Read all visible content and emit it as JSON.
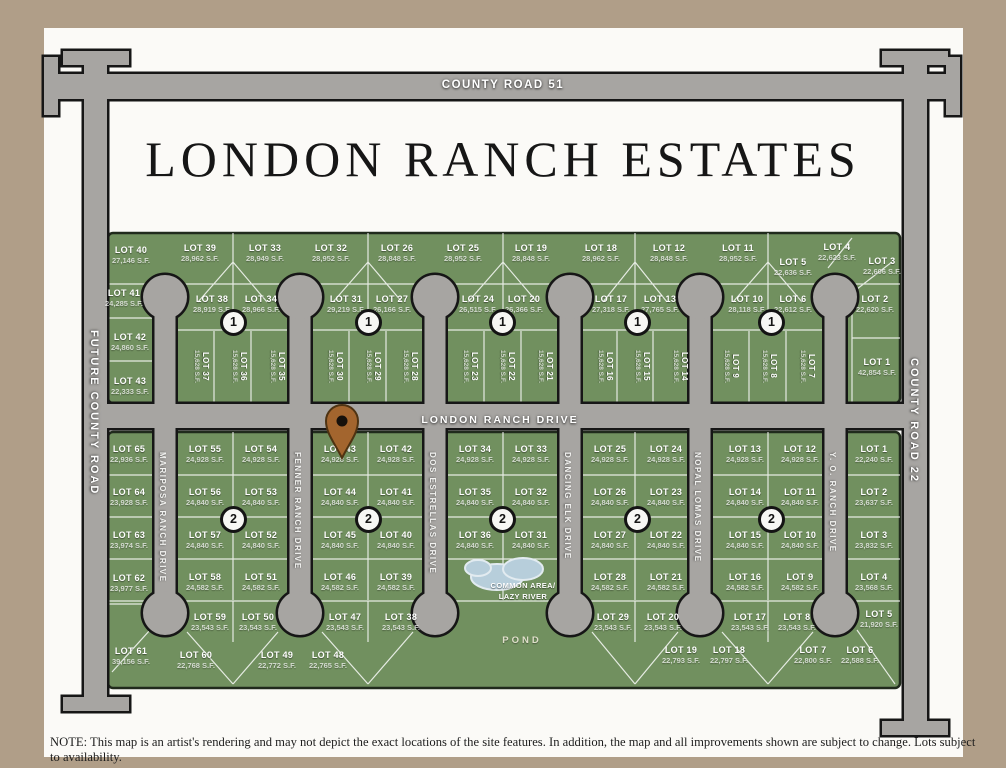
{
  "page": {
    "title": "LONDON RANCH ESTATES",
    "note": "NOTE: This map is an artist's rendering and may not depict the exact locations of the site features. In addition, the map and all improvements shown are subject to change. Lots subject to availability."
  },
  "roads": {
    "county_road_51": "COUNTY ROAD 51",
    "future_county_road": "FUTURE COUNTY ROAD",
    "county_road_22": "COUNTY ROAD 22",
    "london_ranch_drive": "LONDON RANCH DRIVE",
    "drives": [
      {
        "name": "MARIPOSA RANCH DRIVE",
        "x": 165
      },
      {
        "name": "FENNER RANCH DRIVE",
        "x": 300
      },
      {
        "name": "DOS ESTRELLAS DRIVE",
        "x": 435
      },
      {
        "name": "DANCING ELK DRIVE",
        "x": 570
      },
      {
        "name": "NOPAL LOMAS DRIVE",
        "x": 700
      },
      {
        "name": "Y. O. RANCH DRIVE",
        "x": 835
      }
    ]
  },
  "section_markers": [
    {
      "label": "1",
      "points": [
        [
          233,
          322
        ],
        [
          368,
          322
        ],
        [
          502,
          322
        ],
        [
          637,
          322
        ],
        [
          771,
          322
        ]
      ]
    },
    {
      "label": "2",
      "points": [
        [
          233,
          519
        ],
        [
          368,
          519
        ],
        [
          502,
          519
        ],
        [
          637,
          519
        ],
        [
          771,
          519
        ]
      ]
    }
  ],
  "common_area": {
    "line1": "COMMON AREA/",
    "line2": "LAZY RIVER",
    "pond_label": "POND"
  },
  "lots_upper": [
    {
      "n": "LOT 40",
      "sf": "27,146 S.F.",
      "x": 131,
      "y": 254
    },
    {
      "n": "LOT 39",
      "sf": "28,962 S.F.",
      "x": 200,
      "y": 252
    },
    {
      "n": "LOT 33",
      "sf": "28,949 S.F.",
      "x": 265,
      "y": 252
    },
    {
      "n": "LOT 32",
      "sf": "28,952 S.F.",
      "x": 331,
      "y": 252
    },
    {
      "n": "LOT 26",
      "sf": "28,848 S.F.",
      "x": 397,
      "y": 252
    },
    {
      "n": "LOT 25",
      "sf": "28,952 S.F.",
      "x": 463,
      "y": 252
    },
    {
      "n": "LOT 19",
      "sf": "28,848 S.F.",
      "x": 531,
      "y": 252
    },
    {
      "n": "LOT 18",
      "sf": "28,962 S.F.",
      "x": 601,
      "y": 252
    },
    {
      "n": "LOT 12",
      "sf": "28,848 S.F.",
      "x": 669,
      "y": 252
    },
    {
      "n": "LOT 11",
      "sf": "28,952 S.F.",
      "x": 738,
      "y": 252
    },
    {
      "n": "LOT 5",
      "sf": "22,636 S.F.",
      "x": 793,
      "y": 266
    },
    {
      "n": "LOT 4",
      "sf": "22,623 S.F.",
      "x": 837,
      "y": 251
    },
    {
      "n": "LOT 3",
      "sf": "22,606 S.F.",
      "x": 882,
      "y": 265
    },
    {
      "n": "LOT 41",
      "sf": "24,285 S.F.",
      "x": 124,
      "y": 297
    },
    {
      "n": "LOT 38",
      "sf": "28,919 S.F.",
      "x": 212,
      "y": 303
    },
    {
      "n": "LOT 34",
      "sf": "28,966 S.F.",
      "x": 261,
      "y": 303
    },
    {
      "n": "LOT 31",
      "sf": "29,219 S.F.",
      "x": 346,
      "y": 303
    },
    {
      "n": "LOT 27",
      "sf": "26,166 S.F.",
      "x": 392,
      "y": 303
    },
    {
      "n": "LOT 24",
      "sf": "26,515 S.F.",
      "x": 478,
      "y": 303
    },
    {
      "n": "LOT 20",
      "sf": "26,366 S.F.",
      "x": 524,
      "y": 303
    },
    {
      "n": "LOT 17",
      "sf": "27,318 S.F.",
      "x": 611,
      "y": 303
    },
    {
      "n": "LOT 13",
      "sf": "27,765 S.F.",
      "x": 660,
      "y": 303
    },
    {
      "n": "LOT 10",
      "sf": "28,118 S.F.",
      "x": 747,
      "y": 303
    },
    {
      "n": "LOT 6",
      "sf": "22,612 S.F.",
      "x": 793,
      "y": 303
    },
    {
      "n": "LOT 2",
      "sf": "22,620 S.F.",
      "x": 875,
      "y": 303
    },
    {
      "n": "LOT 42",
      "sf": "24,860 S.F.",
      "x": 130,
      "y": 341
    },
    {
      "n": "LOT 43",
      "sf": "22,333 S.F.",
      "x": 130,
      "y": 385
    },
    {
      "n": "LOT 37",
      "sf": "15,628 S.F.",
      "x": 198,
      "y": 366,
      "v": 1
    },
    {
      "n": "LOT 36",
      "sf": "15,628 S.F.",
      "x": 236,
      "y": 366,
      "v": 1
    },
    {
      "n": "LOT 35",
      "sf": "15,628 S.F.",
      "x": 274,
      "y": 366,
      "v": 1
    },
    {
      "n": "LOT 30",
      "sf": "15,628 S.F.",
      "x": 332,
      "y": 366,
      "v": 1
    },
    {
      "n": "LOT 29",
      "sf": "15,628 S.F.",
      "x": 370,
      "y": 366,
      "v": 1
    },
    {
      "n": "LOT 28",
      "sf": "15,628 S.F.",
      "x": 407,
      "y": 366,
      "v": 1
    },
    {
      "n": "LOT 23",
      "sf": "15,628 S.F.",
      "x": 467,
      "y": 366,
      "v": 1
    },
    {
      "n": "LOT 22",
      "sf": "15,628 S.F.",
      "x": 504,
      "y": 366,
      "v": 1
    },
    {
      "n": "LOT 21",
      "sf": "15,628 S.F.",
      "x": 542,
      "y": 366,
      "v": 1
    },
    {
      "n": "LOT 16",
      "sf": "15,628 S.F.",
      "x": 602,
      "y": 366,
      "v": 1
    },
    {
      "n": "LOT 15",
      "sf": "15,628 S.F.",
      "x": 639,
      "y": 366,
      "v": 1
    },
    {
      "n": "LOT 14",
      "sf": "15,628 S.F.",
      "x": 677,
      "y": 366,
      "v": 1
    },
    {
      "n": "LOT 9",
      "sf": "15,628 S.F.",
      "x": 728,
      "y": 366,
      "v": 1
    },
    {
      "n": "LOT 8",
      "sf": "15,628 S.F.",
      "x": 766,
      "y": 366,
      "v": 1
    },
    {
      "n": "LOT 7",
      "sf": "15,628 S.F.",
      "x": 804,
      "y": 366,
      "v": 1
    },
    {
      "n": "LOT 1",
      "sf": "42,854 S.F.",
      "x": 877,
      "y": 366
    }
  ],
  "lots_lower": [
    {
      "n": "LOT 65",
      "sf": "22,936 S.F.",
      "x": 129,
      "y": 453
    },
    {
      "n": "LOT 64",
      "sf": "23,928 S.F.",
      "x": 129,
      "y": 496
    },
    {
      "n": "LOT 63",
      "sf": "23,974 S.F.",
      "x": 129,
      "y": 539
    },
    {
      "n": "LOT 62",
      "sf": "23,977 S.F.",
      "x": 129,
      "y": 582
    },
    {
      "n": "LOT 61",
      "sf": "39,156 S.F.",
      "x": 131,
      "y": 655
    },
    {
      "n": "LOT 55",
      "sf": "24,928 S.F.",
      "x": 205,
      "y": 453
    },
    {
      "n": "LOT 54",
      "sf": "24,928 S.F.",
      "x": 261,
      "y": 453
    },
    {
      "n": "LOT 56",
      "sf": "24,840 S.F.",
      "x": 205,
      "y": 496
    },
    {
      "n": "LOT 53",
      "sf": "24,840 S.F.",
      "x": 261,
      "y": 496
    },
    {
      "n": "LOT 57",
      "sf": "24,840 S.F.",
      "x": 205,
      "y": 539
    },
    {
      "n": "LOT 52",
      "sf": "24,840 S.F.",
      "x": 261,
      "y": 539
    },
    {
      "n": "LOT 58",
      "sf": "24,582 S.F.",
      "x": 205,
      "y": 581
    },
    {
      "n": "LOT 51",
      "sf": "24,582 S.F.",
      "x": 261,
      "y": 581
    },
    {
      "n": "LOT 43",
      "sf": "24,928 S.F.",
      "x": 340,
      "y": 453
    },
    {
      "n": "LOT 42",
      "sf": "24,928 S.F.",
      "x": 396,
      "y": 453
    },
    {
      "n": "LOT 44",
      "sf": "24,840 S.F.",
      "x": 340,
      "y": 496
    },
    {
      "n": "LOT 41",
      "sf": "24,840 S.F.",
      "x": 396,
      "y": 496
    },
    {
      "n": "LOT 45",
      "sf": "24,840 S.F.",
      "x": 340,
      "y": 539
    },
    {
      "n": "LOT 40",
      "sf": "24,840 S.F.",
      "x": 396,
      "y": 539
    },
    {
      "n": "LOT 46",
      "sf": "24,582 S.F.",
      "x": 340,
      "y": 581
    },
    {
      "n": "LOT 39",
      "sf": "24,582 S.F.",
      "x": 396,
      "y": 581
    },
    {
      "n": "LOT 34",
      "sf": "24,928 S.F.",
      "x": 475,
      "y": 453
    },
    {
      "n": "LOT 33",
      "sf": "24,928 S.F.",
      "x": 531,
      "y": 453
    },
    {
      "n": "LOT 35",
      "sf": "24,840 S.F.",
      "x": 475,
      "y": 496
    },
    {
      "n": "LOT 32",
      "sf": "24,840 S.F.",
      "x": 531,
      "y": 496
    },
    {
      "n": "LOT 36",
      "sf": "24,840 S.F.",
      "x": 475,
      "y": 539
    },
    {
      "n": "LOT 31",
      "sf": "24,840 S.F.",
      "x": 531,
      "y": 539
    },
    {
      "n": "LOT 25",
      "sf": "24,928 S.F.",
      "x": 610,
      "y": 453
    },
    {
      "n": "LOT 24",
      "sf": "24,928 S.F.",
      "x": 666,
      "y": 453
    },
    {
      "n": "LOT 26",
      "sf": "24,840 S.F.",
      "x": 610,
      "y": 496
    },
    {
      "n": "LOT 23",
      "sf": "24,840 S.F.",
      "x": 666,
      "y": 496
    },
    {
      "n": "LOT 27",
      "sf": "24,840 S.F.",
      "x": 610,
      "y": 539
    },
    {
      "n": "LOT 22",
      "sf": "24,840 S.F.",
      "x": 666,
      "y": 539
    },
    {
      "n": "LOT 28",
      "sf": "24,582 S.F.",
      "x": 610,
      "y": 581
    },
    {
      "n": "LOT 21",
      "sf": "24,582 S.F.",
      "x": 666,
      "y": 581
    },
    {
      "n": "LOT 13",
      "sf": "24,928 S.F.",
      "x": 745,
      "y": 453
    },
    {
      "n": "LOT 12",
      "sf": "24,928 S.F.",
      "x": 800,
      "y": 453
    },
    {
      "n": "LOT 14",
      "sf": "24,840 S.F.",
      "x": 745,
      "y": 496
    },
    {
      "n": "LOT 11",
      "sf": "24,840 S.F.",
      "x": 800,
      "y": 496
    },
    {
      "n": "LOT 15",
      "sf": "24,840 S.F.",
      "x": 745,
      "y": 539
    },
    {
      "n": "LOT 10",
      "sf": "24,840 S.F.",
      "x": 800,
      "y": 539
    },
    {
      "n": "LOT 16",
      "sf": "24,582 S.F.",
      "x": 745,
      "y": 581
    },
    {
      "n": "LOT 9",
      "sf": "24,582 S.F.",
      "x": 800,
      "y": 581
    },
    {
      "n": "LOT 1",
      "sf": "22,240 S.F.",
      "x": 874,
      "y": 453
    },
    {
      "n": "LOT 2",
      "sf": "23,637 S.F.",
      "x": 874,
      "y": 496
    },
    {
      "n": "LOT 3",
      "sf": "23,832 S.F.",
      "x": 874,
      "y": 539
    },
    {
      "n": "LOT 4",
      "sf": "23,568 S.F.",
      "x": 874,
      "y": 581
    },
    {
      "n": "LOT 59",
      "sf": "23,543 S.F.",
      "x": 210,
      "y": 621
    },
    {
      "n": "LOT 50",
      "sf": "23,543 S.F.",
      "x": 258,
      "y": 621
    },
    {
      "n": "LOT 47",
      "sf": "23,543 S.F.",
      "x": 345,
      "y": 621
    },
    {
      "n": "LOT 38",
      "sf": "23,543 S.F.",
      "x": 401,
      "y": 621
    },
    {
      "n": "LOT 29",
      "sf": "23,543 S.F.",
      "x": 613,
      "y": 621
    },
    {
      "n": "LOT 20",
      "sf": "23,543 S.F.",
      "x": 663,
      "y": 621
    },
    {
      "n": "LOT 17",
      "sf": "23,543 S.F.",
      "x": 750,
      "y": 621
    },
    {
      "n": "LOT 8",
      "sf": "23,543 S.F.",
      "x": 797,
      "y": 621
    },
    {
      "n": "LOT 5",
      "sf": "21,920 S.F.",
      "x": 879,
      "y": 618
    },
    {
      "n": "LOT 60",
      "sf": "22,768 S.F.",
      "x": 196,
      "y": 659
    },
    {
      "n": "LOT 49",
      "sf": "22,772 S.F.",
      "x": 277,
      "y": 659
    },
    {
      "n": "LOT 48",
      "sf": "22,765 S.F.",
      "x": 328,
      "y": 659
    },
    {
      "n": "LOT 19",
      "sf": "22,793 S.F.",
      "x": 681,
      "y": 654
    },
    {
      "n": "LOT 18",
      "sf": "22,797 S.F.",
      "x": 729,
      "y": 654
    },
    {
      "n": "LOT 7",
      "sf": "22,800 S.F.",
      "x": 813,
      "y": 654
    },
    {
      "n": "LOT 6",
      "sf": "22,588 S.F.",
      "x": 860,
      "y": 654
    }
  ],
  "colors": {
    "frame": "#b09e88",
    "lot_green": "#71905f",
    "lot_green_dark": "#202a1c",
    "road_gray": "#a7a5a2",
    "road_dark": "#161616",
    "pond_blue": "#b7cedb",
    "pin_brown": "#a3652e"
  }
}
